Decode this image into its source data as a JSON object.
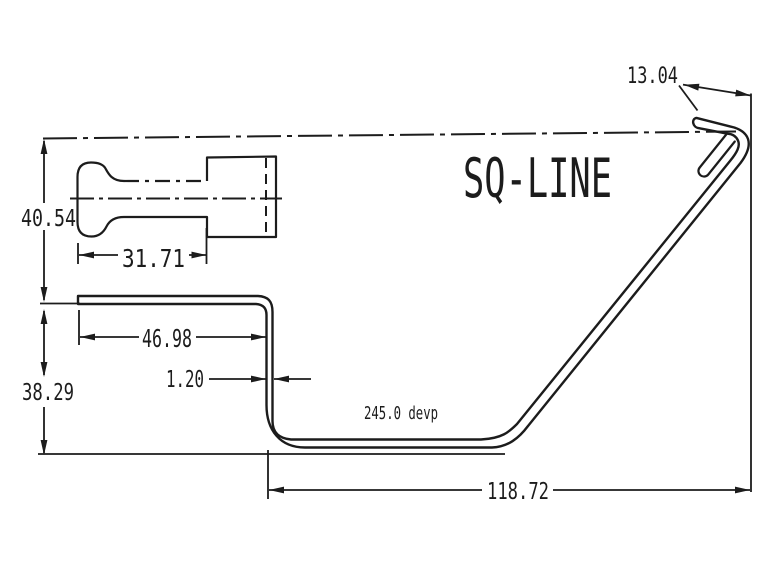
{
  "drawing": {
    "title": "SQ-LINE",
    "note": "245.0 devp",
    "dimensions": {
      "upper_height": "40.54",
      "hem_length": "31.71",
      "top_flange": "46.98",
      "thickness": "1.20",
      "lower_height": "38.29",
      "base_length": "118.72",
      "hook_width": "13.04"
    },
    "colors": {
      "ink": "#1c1c1c",
      "paper": "#ffffff"
    }
  }
}
